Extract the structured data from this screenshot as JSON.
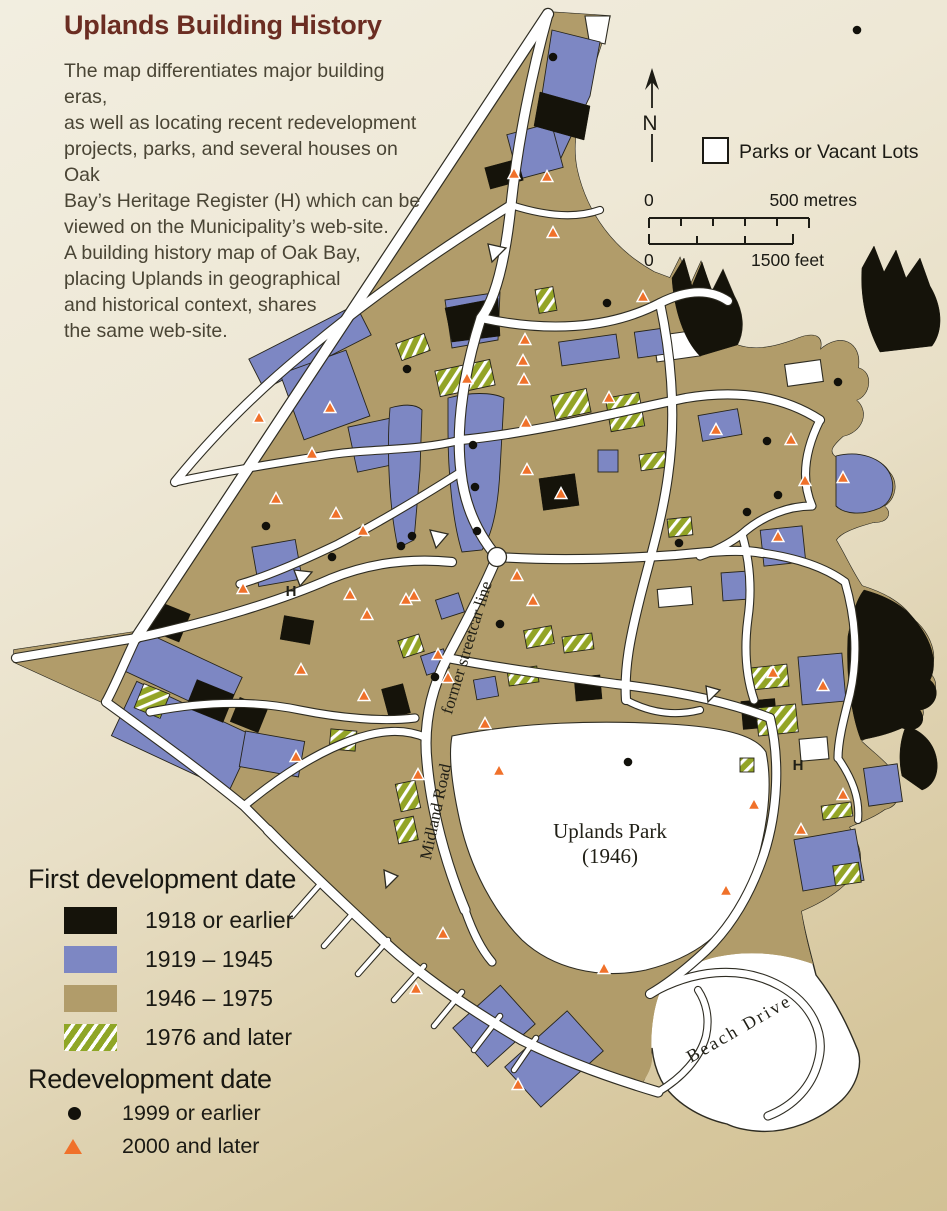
{
  "title": "Uplands Building History",
  "intro": "The map differentiates major building eras,\nas well as locating recent redevelopment\nprojects, parks, and several houses on Oak\nBay’s Heritage Register (H) which can be\nviewed on the Municipality’s web-site.\nA building history map of Oak Bay,\nplacing Uplands in geographical\nand historical context, shares\nthe same web-site.",
  "north": {
    "label": "N"
  },
  "parks_legend": {
    "label": "Parks or Vacant Lots"
  },
  "scale": {
    "metres_zero": "0",
    "metres_max": "500 metres",
    "feet_zero": "0",
    "feet_max": "1500 feet"
  },
  "map_labels": {
    "streetcar": "former streetcar line",
    "midland": "Midland Road",
    "park_line1": "Uplands Park",
    "park_line2": "(1946)",
    "beach": "Beach Drive",
    "heritage_1": "H",
    "heritage_2": "H"
  },
  "development_legend": {
    "heading": "First development date",
    "items": [
      {
        "label": "1918 or earlier",
        "color": "#15130a",
        "hatch": false
      },
      {
        "label": "1919 – 1945",
        "color": "#7d87c3",
        "hatch": false
      },
      {
        "label": "1946 – 1975",
        "color": "#b19c6a",
        "hatch": false
      },
      {
        "label": "1976 and later",
        "color": "#8fa626",
        "hatch": true
      }
    ]
  },
  "redevelopment_legend": {
    "heading": "Redevelopment date",
    "items": [
      {
        "symbol": "dot",
        "label": "1999 or earlier"
      },
      {
        "symbol": "triangle",
        "label": "2000 and later"
      }
    ]
  },
  "colors": {
    "paper_light": "#f2eee0",
    "paper_dark": "#d2c195",
    "land": "#ffffff",
    "era_1918": "#15130a",
    "era_1919_1945": "#7d87c3",
    "era_1946_1975": "#b19c6a",
    "era_1976_later": "#8fa626",
    "redev_triangle": "#f0712a",
    "redev_dot": "#12110b",
    "title_color": "#6b2d22",
    "outline": "#2e2c22"
  },
  "markers": {
    "triangles": [
      [
        514,
        174
      ],
      [
        547,
        177
      ],
      [
        553,
        233
      ],
      [
        643,
        297
      ],
      [
        259,
        418
      ],
      [
        330,
        408
      ],
      [
        312,
        454
      ],
      [
        276,
        499
      ],
      [
        336,
        514
      ],
      [
        363,
        531
      ],
      [
        243,
        589
      ],
      [
        350,
        595
      ],
      [
        367,
        615
      ],
      [
        414,
        596
      ],
      [
        467,
        379
      ],
      [
        525,
        340
      ],
      [
        523,
        361
      ],
      [
        524,
        380
      ],
      [
        526,
        423
      ],
      [
        527,
        470
      ],
      [
        561,
        494
      ],
      [
        609,
        398
      ],
      [
        517,
        576
      ],
      [
        716,
        430
      ],
      [
        791,
        440
      ],
      [
        805,
        481
      ],
      [
        843,
        478
      ],
      [
        778,
        537
      ],
      [
        406,
        600
      ],
      [
        533,
        601
      ],
      [
        438,
        655
      ],
      [
        301,
        670
      ],
      [
        364,
        696
      ],
      [
        448,
        678
      ],
      [
        296,
        757
      ],
      [
        485,
        724
      ],
      [
        418,
        775
      ],
      [
        499,
        771
      ],
      [
        773,
        673
      ],
      [
        823,
        686
      ],
      [
        754,
        805
      ],
      [
        843,
        795
      ],
      [
        801,
        830
      ],
      [
        726,
        891
      ],
      [
        443,
        934
      ],
      [
        416,
        989
      ],
      [
        604,
        969
      ],
      [
        518,
        1085
      ]
    ],
    "dots": [
      [
        553,
        57
      ],
      [
        857,
        30
      ],
      [
        607,
        303
      ],
      [
        838,
        382
      ],
      [
        407,
        369
      ],
      [
        473,
        445
      ],
      [
        475,
        487
      ],
      [
        477,
        531
      ],
      [
        412,
        536
      ],
      [
        401,
        546
      ],
      [
        266,
        526
      ],
      [
        332,
        557
      ],
      [
        500,
        624
      ],
      [
        435,
        677
      ],
      [
        767,
        441
      ],
      [
        778,
        495
      ],
      [
        679,
        543
      ],
      [
        747,
        512
      ],
      [
        628,
        762
      ]
    ]
  }
}
